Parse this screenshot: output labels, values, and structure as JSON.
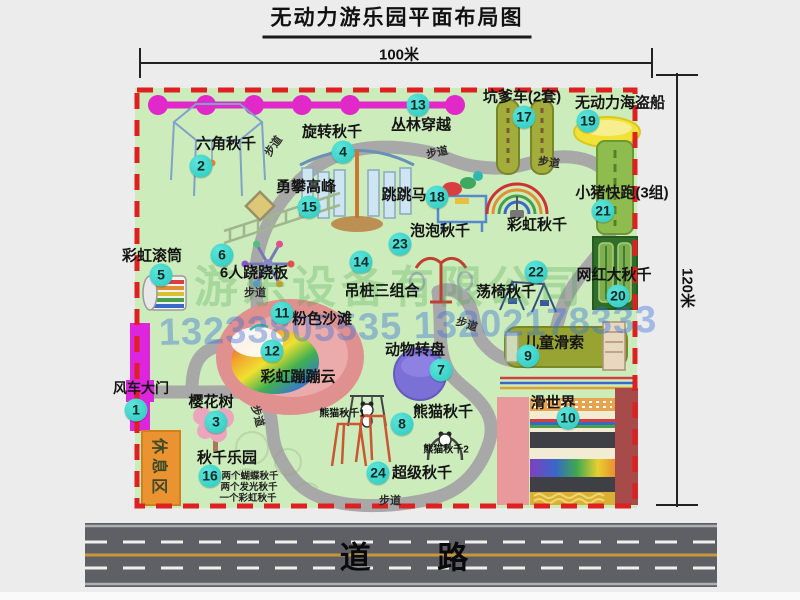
{
  "title": "无动力游乐园平面布局图",
  "dimensions": {
    "width_label": "100米",
    "height_label": "120米"
  },
  "road": {
    "label": "道 路"
  },
  "watermark": {
    "company": "游乐设备有限公司",
    "phones": "13233805535 13202178333"
  },
  "colors": {
    "badge": "#3ed8cf",
    "border_dash": "#dd2020",
    "map_bg": "#cdecbc",
    "gate_magenta": "#dc25dc",
    "road": "#5d5d64",
    "chain_magenta": "#e128c8"
  },
  "map": {
    "items": [
      {
        "num": "1",
        "label": "风车大门",
        "badge": [
          136,
          410
        ],
        "label_pos": [
          141,
          388
        ],
        "fs": 14
      },
      {
        "num": "2",
        "label": "六角秋千",
        "badge": [
          201,
          166
        ],
        "label_pos": [
          226,
          143
        ]
      },
      {
        "num": "3",
        "label": "樱花树",
        "badge": [
          216,
          422
        ],
        "label_pos": [
          211,
          401
        ]
      },
      {
        "num": "4",
        "label": "旋转秋千",
        "badge": [
          343,
          152
        ],
        "label_pos": [
          332,
          131
        ]
      },
      {
        "num": "5",
        "label": "彩虹滚筒",
        "badge": [
          161,
          275
        ],
        "label_pos": [
          152,
          255
        ]
      },
      {
        "num": "6",
        "label": "6人跷跷板",
        "badge": [
          222,
          255
        ],
        "label_pos": [
          254,
          272
        ]
      },
      {
        "num": "7",
        "label": "动物转盘",
        "badge": [
          441,
          370
        ],
        "label_pos": [
          415,
          349
        ]
      },
      {
        "num": "8",
        "label": "熊猫秋千",
        "badge": [
          402,
          424
        ],
        "label_pos": [
          443,
          411
        ]
      },
      {
        "num": "9",
        "label": "儿童滑索",
        "badge": [
          528,
          356
        ],
        "label_pos": [
          554,
          342
        ]
      },
      {
        "num": "10",
        "label": "滑世界",
        "badge": [
          568,
          418
        ],
        "label_pos": [
          553,
          402
        ]
      },
      {
        "num": "11",
        "label": "粉色沙滩",
        "badge": [
          282,
          313
        ],
        "label_pos": [
          322,
          318
        ]
      },
      {
        "num": "12",
        "label": "彩虹蹦蹦云",
        "badge": [
          272,
          351
        ],
        "label_pos": [
          298,
          376
        ]
      },
      {
        "num": "13",
        "label": "丛林穿越",
        "badge": [
          418,
          105
        ],
        "label_pos": [
          421,
          124
        ]
      },
      {
        "num": "14",
        "label": "吊桩三组合",
        "badge": [
          361,
          262
        ],
        "label_pos": [
          382,
          290
        ]
      },
      {
        "num": "15",
        "label": "勇攀高峰",
        "badge": [
          309,
          207
        ],
        "label_pos": [
          306,
          186
        ]
      },
      {
        "num": "16",
        "label": "秋千乐园",
        "badge": [
          210,
          476
        ],
        "label_pos": [
          227,
          457
        ]
      },
      {
        "num": "17",
        "label": "坑爹车(2套)",
        "badge": [
          524,
          117
        ],
        "label_pos": [
          522,
          96
        ]
      },
      {
        "num": "18",
        "label": "跳跳马",
        "badge": [
          437,
          197
        ],
        "label_pos": [
          404,
          194
        ]
      },
      {
        "num": "19",
        "label": "无动力海盗船",
        "badge": [
          588,
          121
        ],
        "label_pos": [
          620,
          102
        ]
      },
      {
        "num": "20",
        "label": "网红大秋千",
        "badge": [
          618,
          296
        ],
        "label_pos": [
          614,
          274
        ]
      },
      {
        "num": "21",
        "label": "小猪快跑(3组)",
        "badge": [
          603,
          211
        ],
        "label_pos": [
          622,
          192
        ]
      },
      {
        "num": "22",
        "label": "荡椅秋千",
        "badge": [
          536,
          272
        ],
        "label_pos": [
          506,
          291
        ]
      },
      {
        "num": "23",
        "label": "泡泡秋千",
        "badge": [
          400,
          244
        ],
        "label_pos": [
          440,
          230
        ]
      },
      {
        "num": "24",
        "label": "超级秋千",
        "badge": [
          378,
          473
        ],
        "label_pos": [
          422,
          472
        ]
      }
    ],
    "extra_labels": [
      {
        "name": "rainbow-swing-label",
        "text": "彩虹秋千",
        "x": 537,
        "y": 224
      },
      {
        "name": "rest-area-label",
        "text": "休息区",
        "x": 161,
        "y": 468,
        "rot": 90,
        "cls": "rest-label"
      },
      {
        "name": "panda-swing-1-label",
        "text": "熊猫秋千1",
        "x": 342,
        "y": 412,
        "fs": 10
      },
      {
        "name": "panda-swing-2-label",
        "text": "熊猫秋千2",
        "x": 446,
        "y": 448,
        "fs": 10
      }
    ],
    "path_labels": [
      {
        "text": "步道",
        "x": 273,
        "y": 146,
        "rot": -55
      },
      {
        "text": "步道",
        "x": 437,
        "y": 152,
        "rot": -12
      },
      {
        "text": "步道",
        "x": 549,
        "y": 162,
        "rot": 8
      },
      {
        "text": "步道",
        "x": 255,
        "y": 292,
        "rot": 0
      },
      {
        "text": "步道",
        "x": 467,
        "y": 324,
        "rot": 18
      },
      {
        "text": "步道",
        "x": 258,
        "y": 416,
        "rot": 75
      },
      {
        "text": "步道",
        "x": 390,
        "y": 500,
        "rot": 0
      }
    ],
    "notes": [
      {
        "text": "两个蝴蝶秋千",
        "x": 250,
        "y": 475
      },
      {
        "text": "两个发光秋千",
        "x": 249,
        "y": 486
      },
      {
        "text": "一个彩虹秋千",
        "x": 248,
        "y": 497
      }
    ]
  }
}
